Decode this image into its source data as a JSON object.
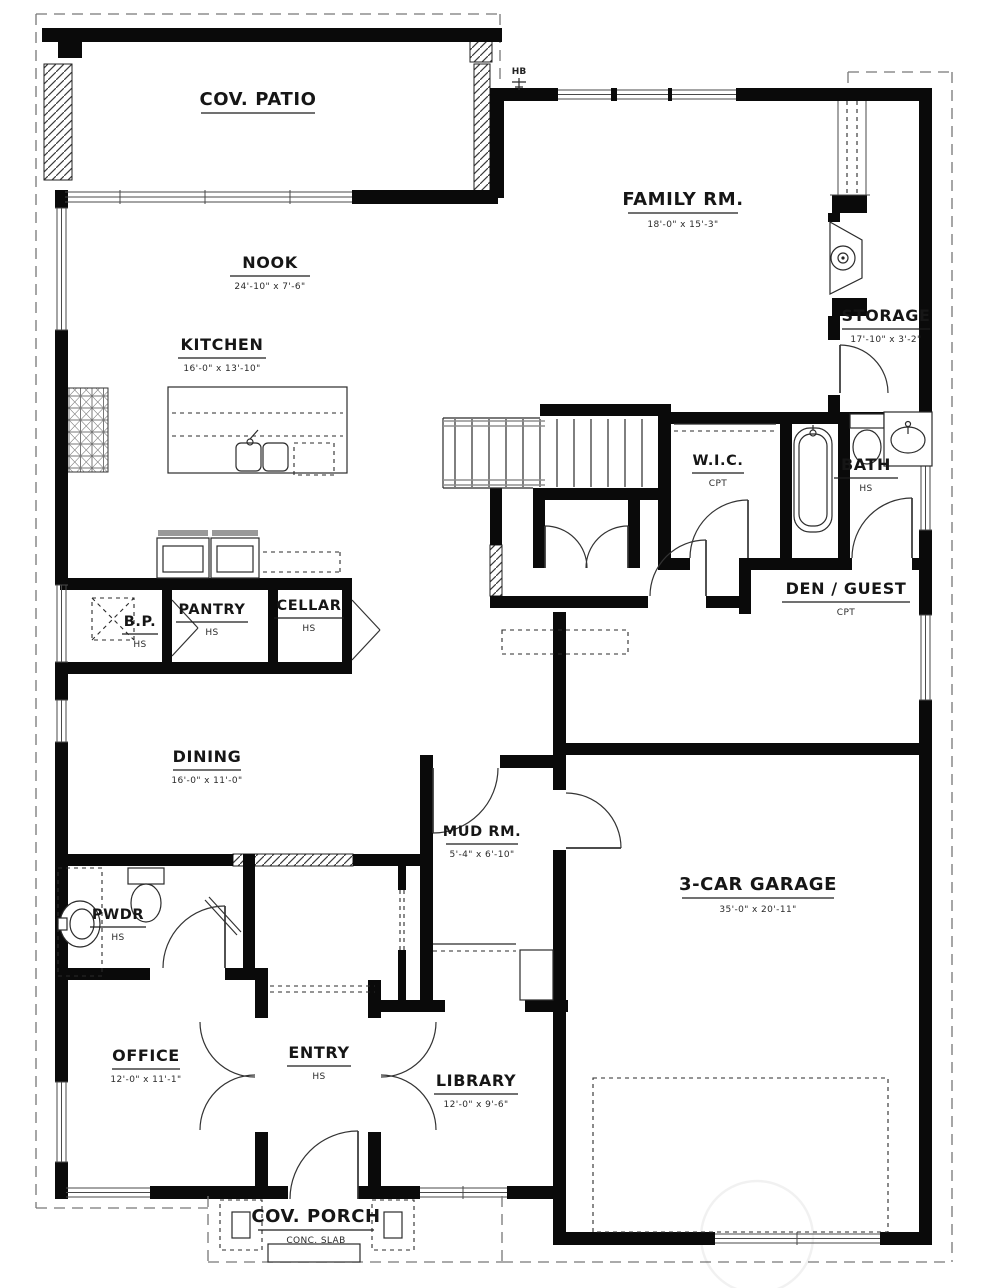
{
  "drawing": {
    "type": "first-floor plan",
    "flooring_codes": {
      "HS": "HS",
      "CPT": "CPT"
    }
  },
  "rooms": {
    "cov_patio": {
      "label": "COV. PATIO",
      "sub": ""
    },
    "nook": {
      "label": "NOOK",
      "sub": "24'-10\" x 7'-6\""
    },
    "kitchen": {
      "label": "KITCHEN",
      "sub": "16'-0\" x 13'-10\""
    },
    "family_rm": {
      "label": "FAMILY RM.",
      "sub": "18'-0\" x 15'-3\""
    },
    "storage": {
      "label": "STORAGE",
      "sub": "17'-10\" x 3'-2\""
    },
    "wic": {
      "label": "W.I.C.",
      "sub": "CPT"
    },
    "bath": {
      "label": "BATH",
      "sub": "HS"
    },
    "den_guest": {
      "label": "DEN / GUEST",
      "sub": "CPT"
    },
    "bp": {
      "label": "B.P.",
      "sub": "HS"
    },
    "pantry": {
      "label": "PANTRY",
      "sub": "HS"
    },
    "cellar": {
      "label": "CELLAR",
      "sub": "HS"
    },
    "dining": {
      "label": "DINING",
      "sub": "16'-0\" x 11'-0\""
    },
    "mud_rm": {
      "label": "MUD RM.",
      "sub": "5'-4\" x 6'-10\""
    },
    "garage": {
      "label": "3-CAR GARAGE",
      "sub": "35'-0\" x 20'-11\""
    },
    "pwdr": {
      "label": "PWDR",
      "sub": "HS"
    },
    "office": {
      "label": "OFFICE",
      "sub": "12'-0\" x 11'-1\""
    },
    "entry": {
      "label": "ENTRY",
      "sub": "HS"
    },
    "library": {
      "label": "LIBRARY",
      "sub": "12'-0\" x 9'-6\""
    },
    "cov_porch": {
      "label": "COV. PORCH",
      "sub": "CONC. SLAB"
    }
  },
  "annotations": {
    "hose_bib": "HB"
  },
  "colors": {
    "wall": "#0a0a0a",
    "line": "#2b2b2b",
    "gray": "#8f8f8f",
    "paper": "#ffffff"
  }
}
